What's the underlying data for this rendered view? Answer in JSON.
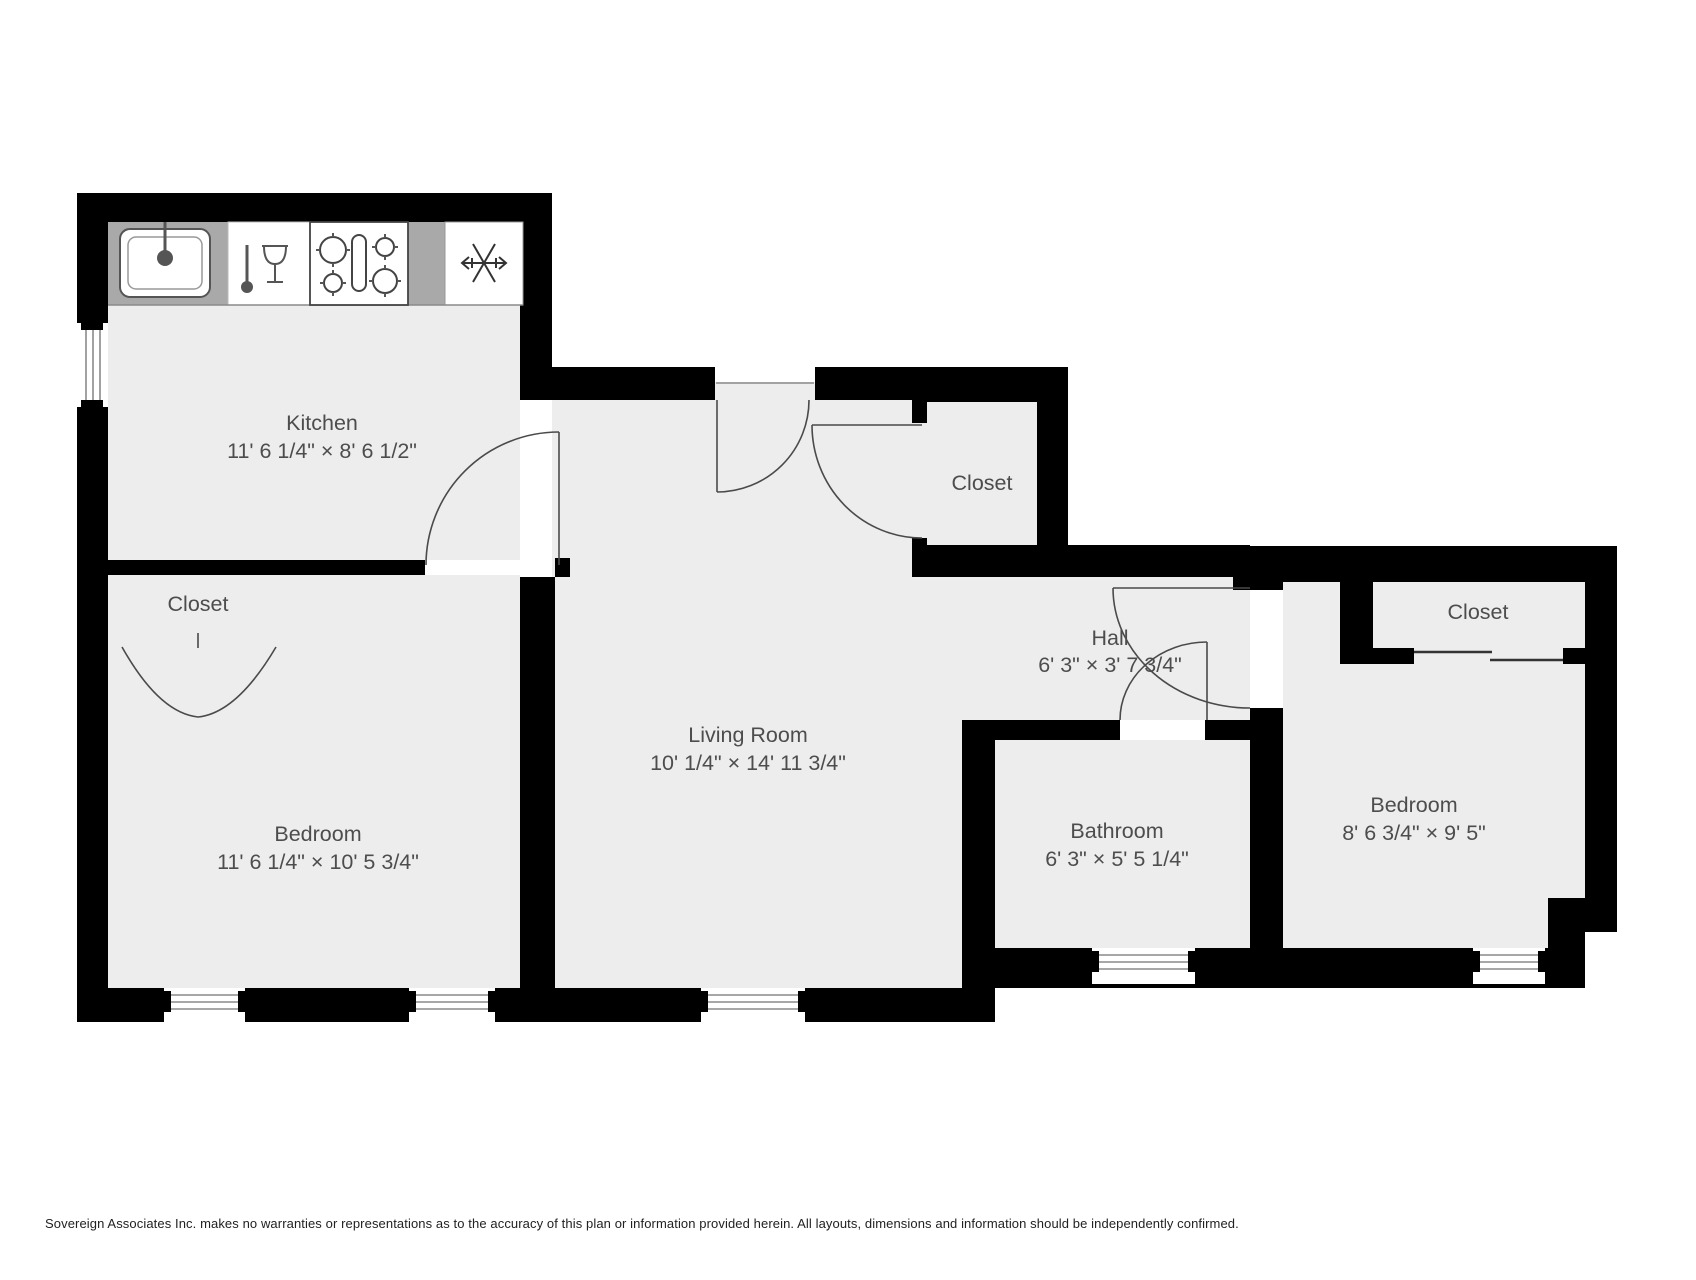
{
  "plan": {
    "background": "#ffffff",
    "floor_color": "#ededed",
    "wall_color": "#000000",
    "counter_color": "#a9a9a9",
    "accent_line_color": "#4a4a4a",
    "label_color": "#4d4d4d"
  },
  "rooms": [
    {
      "name": "Kitchen",
      "dims": "11' 6 1/4\" × 8' 6 1/2\""
    },
    {
      "name": "Closet",
      "dims": ""
    },
    {
      "name": "Bedroom",
      "dims": "11' 6 1/4\" × 10' 5 3/4\""
    },
    {
      "name": "Living Room",
      "dims": "10' 1/4\" × 14' 11 3/4\""
    },
    {
      "name": "Closet",
      "dims": ""
    },
    {
      "name": "Hall",
      "dims": "6' 3\" × 3' 7 3/4\""
    },
    {
      "name": "Bathroom",
      "dims": "6' 3\" × 5' 5 1/4\""
    },
    {
      "name": "Bedroom",
      "dims": "8' 6 3/4\" × 9' 5\""
    },
    {
      "name": "Closet",
      "dims": ""
    }
  ],
  "fixtures": {
    "sink": "kitchen sink",
    "dishwasher": "dishwasher",
    "stove": "4-burner stove",
    "freezer": "refrigerator-freezer"
  },
  "footer": {
    "disclaimer": "Sovereign Associates Inc. makes no warranties or representations as to the accuracy of this plan or information provided herein. All layouts, dimensions and information should be independently confirmed."
  }
}
